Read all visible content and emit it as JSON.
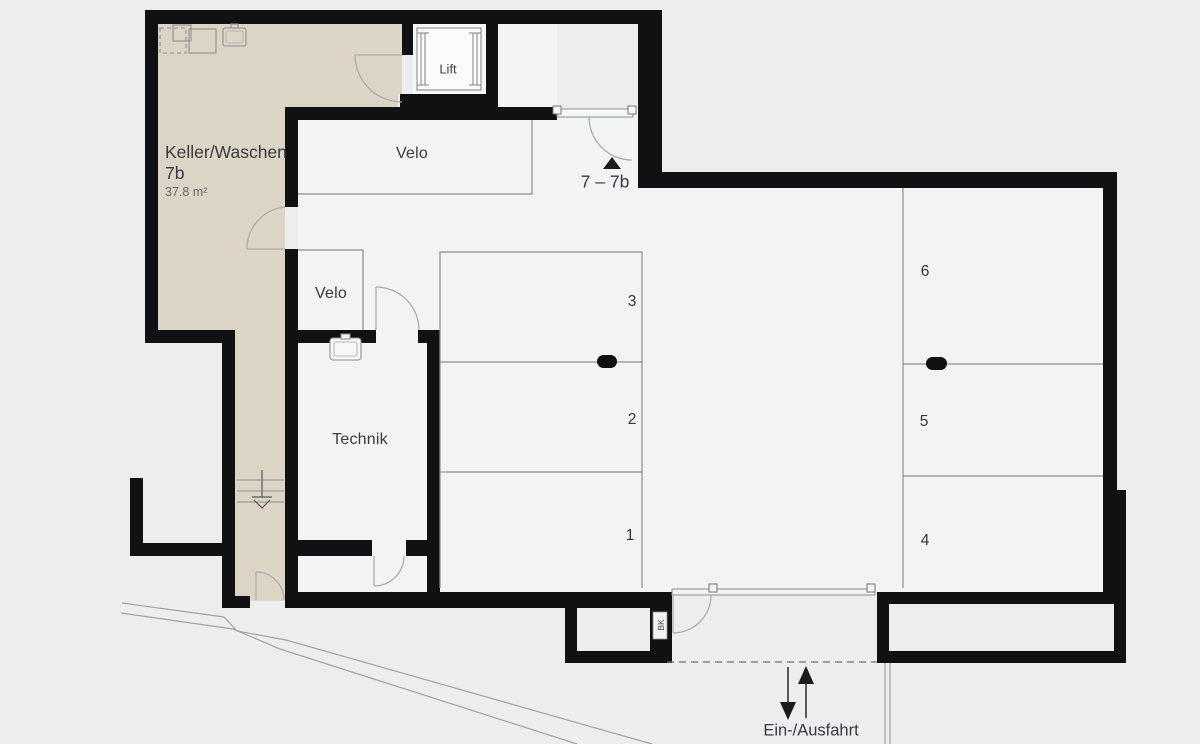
{
  "floorplan": {
    "keller": {
      "name": "Keller/Waschen",
      "unit": "7b",
      "area": "37.8 m²"
    },
    "rooms": {
      "velo_top": "Velo",
      "velo_small": "Velo",
      "technik": "Technik",
      "lift": "Lift"
    },
    "unit_range": "7 – 7b",
    "parking_left": [
      "3",
      "2",
      "1"
    ],
    "parking_right": [
      "6",
      "5",
      "4"
    ],
    "entrance": "Ein-/Ausfahrt",
    "duct": "BK",
    "colors": {
      "background": "#ecedee",
      "floor": "#f2f3f3",
      "keller_fill": "#dcd4c5",
      "wall": "#101112",
      "thin_line": "#8b8f92",
      "door_line": "#a8adb0",
      "text": "#363b41"
    }
  }
}
